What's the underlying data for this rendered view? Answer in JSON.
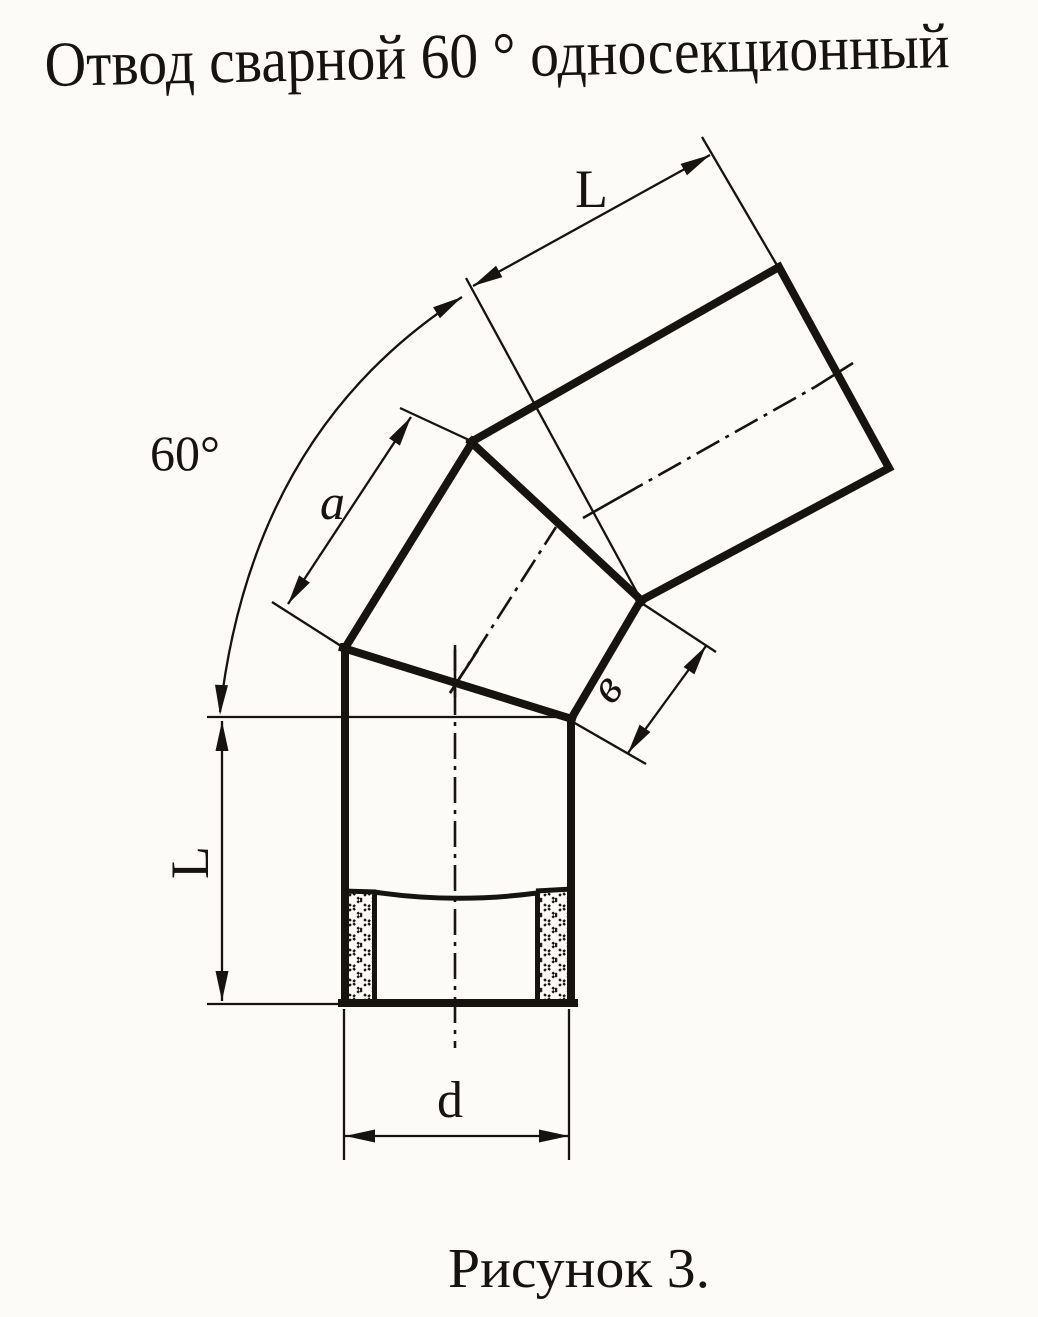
{
  "title": "Отвод сварной 60 ° односекционный",
  "caption": "Рисунок 3.",
  "dimensions": {
    "bend_angle": "60°",
    "top_segment_length": "L",
    "section_outer_side": "a",
    "section_inner_side": "в",
    "bottom_segment_length": "L",
    "pipe_diameter": "d"
  },
  "colors": {
    "paper": "#fcfbf8",
    "ink": "#17130f"
  }
}
